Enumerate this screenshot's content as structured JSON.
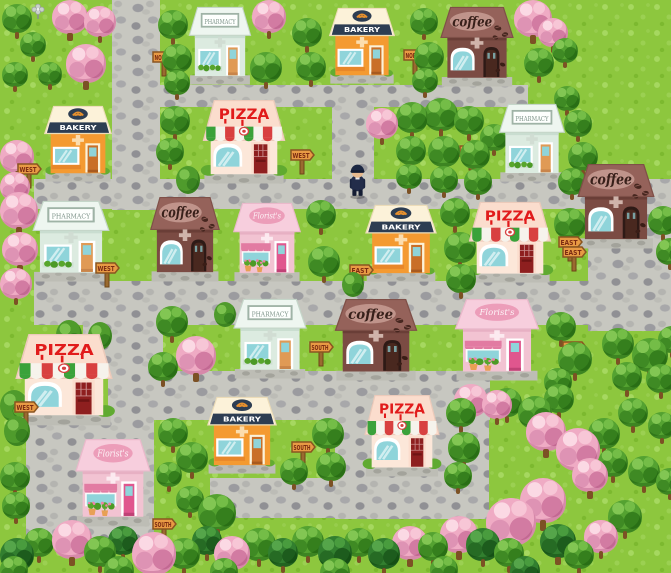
{
  "scene": {
    "name": "shop-town-map",
    "width": 671,
    "height": 573,
    "colors": {
      "grass": "#8dc73e",
      "road": "#c7c7c0",
      "sign_panel": "#e89a44",
      "sign_text": "#7c2b12",
      "pharmacy_roof": "#eef6f0",
      "bakery_wall": "#f49a31",
      "bakery_band": "#2d3d52",
      "coffee_wall": "#7b4b43",
      "pizza_red": "#e11b1b",
      "florist_pink": "#f2c3d2",
      "window_glass": "#8fd4da"
    },
    "labels": {
      "pharmacy": "PHARMACY",
      "bakery": "BAKERY",
      "coffee": "coffee",
      "pizza": "PIZZA",
      "florist": "Florist's"
    },
    "character": {
      "desc": "small officer in dark cap and suit standing on road",
      "x": 347,
      "y": 162,
      "w": 21,
      "h": 37
    },
    "roads": [
      [
        112,
        0,
        48,
        210
      ],
      [
        112,
        85,
        416,
        22
      ],
      [
        332,
        85,
        42,
        102
      ],
      [
        34,
        179,
        637,
        30
      ],
      [
        588,
        200,
        83,
        131
      ],
      [
        34,
        281,
        564,
        44
      ],
      [
        83,
        281,
        80,
        98
      ],
      [
        108,
        371,
        382,
        49
      ],
      [
        26,
        419,
        128,
        127
      ],
      [
        335,
        374,
        154,
        145
      ],
      [
        210,
        478,
        130,
        40
      ]
    ],
    "buildings": [
      {
        "type": "pharmacy",
        "label": "PHARMACY",
        "x": 186,
        "y": 6,
        "w": 68,
        "h": 80
      },
      {
        "type": "bakery",
        "label": "BAKERY",
        "x": 326,
        "y": 7,
        "w": 72,
        "h": 78
      },
      {
        "type": "coffee",
        "label": "coffee",
        "x": 437,
        "y": 6,
        "w": 80,
        "h": 82
      },
      {
        "type": "bakery",
        "label": "BAKERY",
        "x": 41,
        "y": 105,
        "w": 74,
        "h": 78
      },
      {
        "type": "pizza",
        "label": "PIZZA",
        "x": 199,
        "y": 99,
        "w": 90,
        "h": 86
      },
      {
        "type": "pharmacy",
        "label": "PHARMACY",
        "x": 496,
        "y": 103,
        "w": 72,
        "h": 80
      },
      {
        "type": "coffee",
        "label": "coffee",
        "x": 574,
        "y": 163,
        "w": 84,
        "h": 87
      },
      {
        "type": "pharmacy",
        "label": "PHARMACY",
        "x": 29,
        "y": 200,
        "w": 84,
        "h": 83
      },
      {
        "type": "coffee",
        "label": "coffee",
        "x": 147,
        "y": 196,
        "w": 76,
        "h": 87
      },
      {
        "type": "florist",
        "label": "Florist's",
        "x": 230,
        "y": 202,
        "w": 74,
        "h": 81
      },
      {
        "type": "bakery",
        "label": "BAKERY",
        "x": 362,
        "y": 204,
        "w": 78,
        "h": 79
      },
      {
        "type": "pizza",
        "label": "PIZZA",
        "x": 465,
        "y": 201,
        "w": 90,
        "h": 83
      },
      {
        "type": "pharmacy",
        "label": "PHARMACY",
        "x": 230,
        "y": 298,
        "w": 80,
        "h": 82
      },
      {
        "type": "coffee",
        "label": "coffee",
        "x": 331,
        "y": 298,
        "w": 90,
        "h": 84
      },
      {
        "type": "florist",
        "label": "Florist's",
        "x": 451,
        "y": 298,
        "w": 92,
        "h": 84
      },
      {
        "type": "pizza",
        "label": "PIZZA",
        "x": 11,
        "y": 333,
        "w": 106,
        "h": 94
      },
      {
        "type": "bakery",
        "label": "BAKERY",
        "x": 204,
        "y": 396,
        "w": 76,
        "h": 79
      },
      {
        "type": "pizza",
        "label": "PIZZA",
        "x": 361,
        "y": 394,
        "w": 82,
        "h": 84
      },
      {
        "type": "florist",
        "label": "Florist's",
        "x": 72,
        "y": 438,
        "w": 82,
        "h": 90
      }
    ],
    "signs": [
      {
        "text": "NORTH",
        "x": 151,
        "y": 46
      },
      {
        "text": "NORTH",
        "x": 402,
        "y": 44
      },
      {
        "text": "WEST",
        "x": 16,
        "y": 158
      },
      {
        "text": "WEST",
        "x": 289,
        "y": 144
      },
      {
        "text": "EAST",
        "x": 458,
        "y": 140
      },
      {
        "text": "EAST",
        "x": 557,
        "y": 231
      },
      {
        "text": "WEST",
        "x": 94,
        "y": 257
      },
      {
        "text": "EAST",
        "x": 348,
        "y": 259
      },
      {
        "text": "EAST",
        "x": 561,
        "y": 241
      },
      {
        "text": "SOUTH",
        "x": 308,
        "y": 336
      },
      {
        "text": "EAST",
        "x": 561,
        "y": 336
      },
      {
        "text": "WEST",
        "x": 13,
        "y": 396
      },
      {
        "text": "SOUTH",
        "x": 290,
        "y": 436
      },
      {
        "text": "SOUTH",
        "x": 151,
        "y": 513
      }
    ],
    "trees": [
      [
        "g",
        2,
        4,
        30
      ],
      [
        "p",
        52,
        0,
        36
      ],
      [
        "p",
        84,
        6,
        32
      ],
      [
        "w",
        30,
        2,
        16
      ],
      [
        "g",
        20,
        32,
        26
      ],
      [
        "p",
        66,
        44,
        40
      ],
      [
        "g",
        2,
        62,
        26
      ],
      [
        "g",
        38,
        62,
        24
      ],
      [
        "p",
        0,
        140,
        34
      ],
      [
        "p",
        0,
        172,
        30
      ],
      [
        "g",
        158,
        10,
        30
      ],
      [
        "g",
        162,
        44,
        30
      ],
      [
        "g",
        164,
        70,
        26
      ],
      [
        "p",
        252,
        0,
        34
      ],
      [
        "g",
        292,
        18,
        30
      ],
      [
        "g",
        250,
        52,
        32
      ],
      [
        "g",
        296,
        52,
        30
      ],
      [
        "g",
        410,
        8,
        28
      ],
      [
        "g",
        414,
        42,
        30
      ],
      [
        "g",
        412,
        68,
        26
      ],
      [
        "p",
        514,
        0,
        38
      ],
      [
        "p",
        538,
        18,
        30
      ],
      [
        "g",
        524,
        48,
        30
      ],
      [
        "g",
        552,
        38,
        26
      ],
      [
        "g",
        554,
        86,
        26
      ],
      [
        "g",
        160,
        106,
        30
      ],
      [
        "g",
        156,
        138,
        28
      ],
      [
        "b",
        176,
        166,
        24
      ],
      [
        "p",
        366,
        108,
        32
      ],
      [
        "g",
        396,
        102,
        32
      ],
      [
        "g",
        424,
        98,
        34
      ],
      [
        "g",
        454,
        106,
        30
      ],
      [
        "g",
        480,
        124,
        28
      ],
      [
        "g",
        396,
        136,
        30
      ],
      [
        "g",
        428,
        136,
        32
      ],
      [
        "g",
        460,
        140,
        30
      ],
      [
        "g",
        396,
        164,
        26
      ],
      [
        "g",
        430,
        166,
        28
      ],
      [
        "g",
        464,
        168,
        28
      ],
      [
        "g",
        564,
        110,
        28
      ],
      [
        "g",
        568,
        142,
        30
      ],
      [
        "g",
        558,
        168,
        28
      ],
      [
        "g",
        648,
        206,
        30
      ],
      [
        "g",
        656,
        238,
        28
      ],
      [
        "g",
        554,
        208,
        32
      ],
      [
        "p",
        0,
        192,
        38
      ],
      [
        "p",
        2,
        232,
        36
      ],
      [
        "p",
        0,
        268,
        32
      ],
      [
        "g",
        306,
        200,
        30
      ],
      [
        "g",
        308,
        246,
        32
      ],
      [
        "b",
        342,
        272,
        22
      ],
      [
        "g",
        440,
        198,
        30
      ],
      [
        "g",
        444,
        232,
        32
      ],
      [
        "g",
        446,
        264,
        30
      ],
      [
        "g",
        156,
        306,
        32
      ],
      [
        "p",
        176,
        336,
        40
      ],
      [
        "g",
        148,
        352,
        30
      ],
      [
        "b",
        214,
        302,
        22
      ],
      [
        "b",
        56,
        320,
        26
      ],
      [
        "b",
        88,
        322,
        24
      ],
      [
        "g",
        546,
        312,
        30
      ],
      [
        "g",
        558,
        342,
        34
      ],
      [
        "g",
        544,
        368,
        28
      ],
      [
        "g",
        602,
        328,
        32
      ],
      [
        "g",
        632,
        338,
        36
      ],
      [
        "g",
        658,
        326,
        28
      ],
      [
        "g",
        612,
        362,
        30
      ],
      [
        "g",
        646,
        364,
        30
      ],
      [
        "b",
        0,
        390,
        28
      ],
      [
        "b",
        4,
        416,
        26
      ],
      [
        "g",
        158,
        418,
        30
      ],
      [
        "g",
        176,
        442,
        32
      ],
      [
        "g",
        156,
        462,
        26
      ],
      [
        "g",
        312,
        418,
        32
      ],
      [
        "g",
        280,
        458,
        28
      ],
      [
        "g",
        316,
        452,
        30
      ],
      [
        "p",
        454,
        384,
        34
      ],
      [
        "p",
        482,
        390,
        30
      ],
      [
        "g",
        446,
        398,
        30
      ],
      [
        "g",
        448,
        432,
        32
      ],
      [
        "g",
        444,
        462,
        28
      ],
      [
        "g",
        492,
        388,
        30
      ],
      [
        "g",
        518,
        396,
        34
      ],
      [
        "g",
        544,
        384,
        30
      ],
      [
        "p",
        526,
        412,
        40
      ],
      [
        "p",
        556,
        428,
        44
      ],
      [
        "g",
        588,
        418,
        32
      ],
      [
        "g",
        618,
        398,
        30
      ],
      [
        "g",
        648,
        412,
        28
      ],
      [
        "g",
        598,
        448,
        30
      ],
      [
        "p",
        572,
        458,
        36
      ],
      [
        "g",
        628,
        456,
        32
      ],
      [
        "g",
        656,
        468,
        28
      ],
      [
        "g",
        0,
        462,
        30
      ],
      [
        "g",
        2,
        492,
        28
      ],
      [
        "g",
        176,
        486,
        28
      ],
      [
        "g",
        198,
        494,
        38
      ],
      [
        "g",
        608,
        500,
        34
      ],
      [
        "d",
        0,
        538,
        34
      ],
      [
        "g",
        24,
        528,
        30
      ],
      [
        "p",
        52,
        520,
        40
      ],
      [
        "g",
        84,
        536,
        32
      ],
      [
        "d",
        108,
        526,
        30
      ],
      [
        "p",
        132,
        532,
        44
      ],
      [
        "g",
        168,
        538,
        32
      ],
      [
        "d",
        192,
        526,
        30
      ],
      [
        "p",
        214,
        536,
        36
      ],
      [
        "g",
        242,
        528,
        34
      ],
      [
        "d",
        268,
        538,
        30
      ],
      [
        "g",
        292,
        526,
        32
      ],
      [
        "d",
        318,
        536,
        34
      ],
      [
        "g",
        344,
        528,
        30
      ],
      [
        "d",
        368,
        538,
        32
      ],
      [
        "p",
        392,
        526,
        36
      ],
      [
        "g",
        418,
        532,
        30
      ],
      [
        "p",
        440,
        516,
        38
      ],
      [
        "p",
        486,
        498,
        50
      ],
      [
        "p",
        520,
        478,
        46
      ],
      [
        "d",
        466,
        528,
        34
      ],
      [
        "g",
        494,
        538,
        30
      ],
      [
        "d",
        540,
        524,
        36
      ],
      [
        "g",
        564,
        540,
        30
      ],
      [
        "p",
        584,
        520,
        34
      ],
      [
        "d",
        510,
        556,
        30
      ],
      [
        "g",
        0,
        556,
        28
      ],
      [
        "g",
        104,
        556,
        30
      ],
      [
        "g",
        210,
        558,
        28
      ],
      [
        "g",
        320,
        558,
        30
      ],
      [
        "g",
        430,
        556,
        28
      ]
    ]
  }
}
